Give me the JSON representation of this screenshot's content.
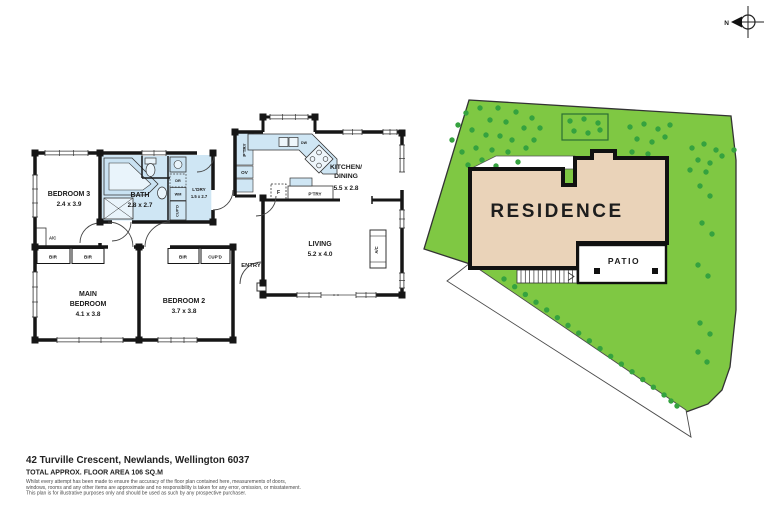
{
  "site": {
    "residence": "RESIDENCE",
    "patio": "PATIO",
    "north": "N"
  },
  "fp": {
    "bedroom3": "BEDROOM 3",
    "bedroom3_d": "2.4 x 3.9",
    "bath": "BATH",
    "bath_d": "2.8 x 2.7",
    "ldry": "L'DRY",
    "ldry_d": "1.5 x 2.7",
    "kitchen1": "KITCHEN/",
    "kitchen2": "DINING",
    "kitchen_d": "5.5 x 2.8",
    "living": "LIVING",
    "living_d": "5.2 x 4.0",
    "main1": "MAIN",
    "main2": "BEDROOM",
    "main_d": "4.1 x 3.8",
    "bed2": "BEDROOM 2",
    "bed2_d": "3.7 x 3.8",
    "entry": "ENTRY",
    "ac": "A/C",
    "bir": "BIR",
    "cupd": "CUP'D",
    "ptry": "P'TRY",
    "ov": "OV",
    "dw": "DW",
    "f": "F",
    "dr": "DR",
    "wm": "WM"
  },
  "footer": {
    "address": "42 Turville Crescent, Newlands, Wellington 6037",
    "area": "TOTAL APPROX. FLOOR AREA 106 SQ.M",
    "disc1": "Whilst every attempt has been made to ensure the accuracy of the floor plan contained here, measurements of doors,",
    "disc2": "windows, rooms and any other items are approximate and no responsibility is taken for any error, omission, or misstatement.",
    "disc3": "This plan is for illustrative purposes only and should be used as such by any prospective purchaser."
  },
  "colors": {
    "grass": "#7fc843",
    "tree": "#35a23f",
    "residence_fill": "#ead3b9",
    "wet_area": "#cfe6f4",
    "wall": "#161616"
  }
}
